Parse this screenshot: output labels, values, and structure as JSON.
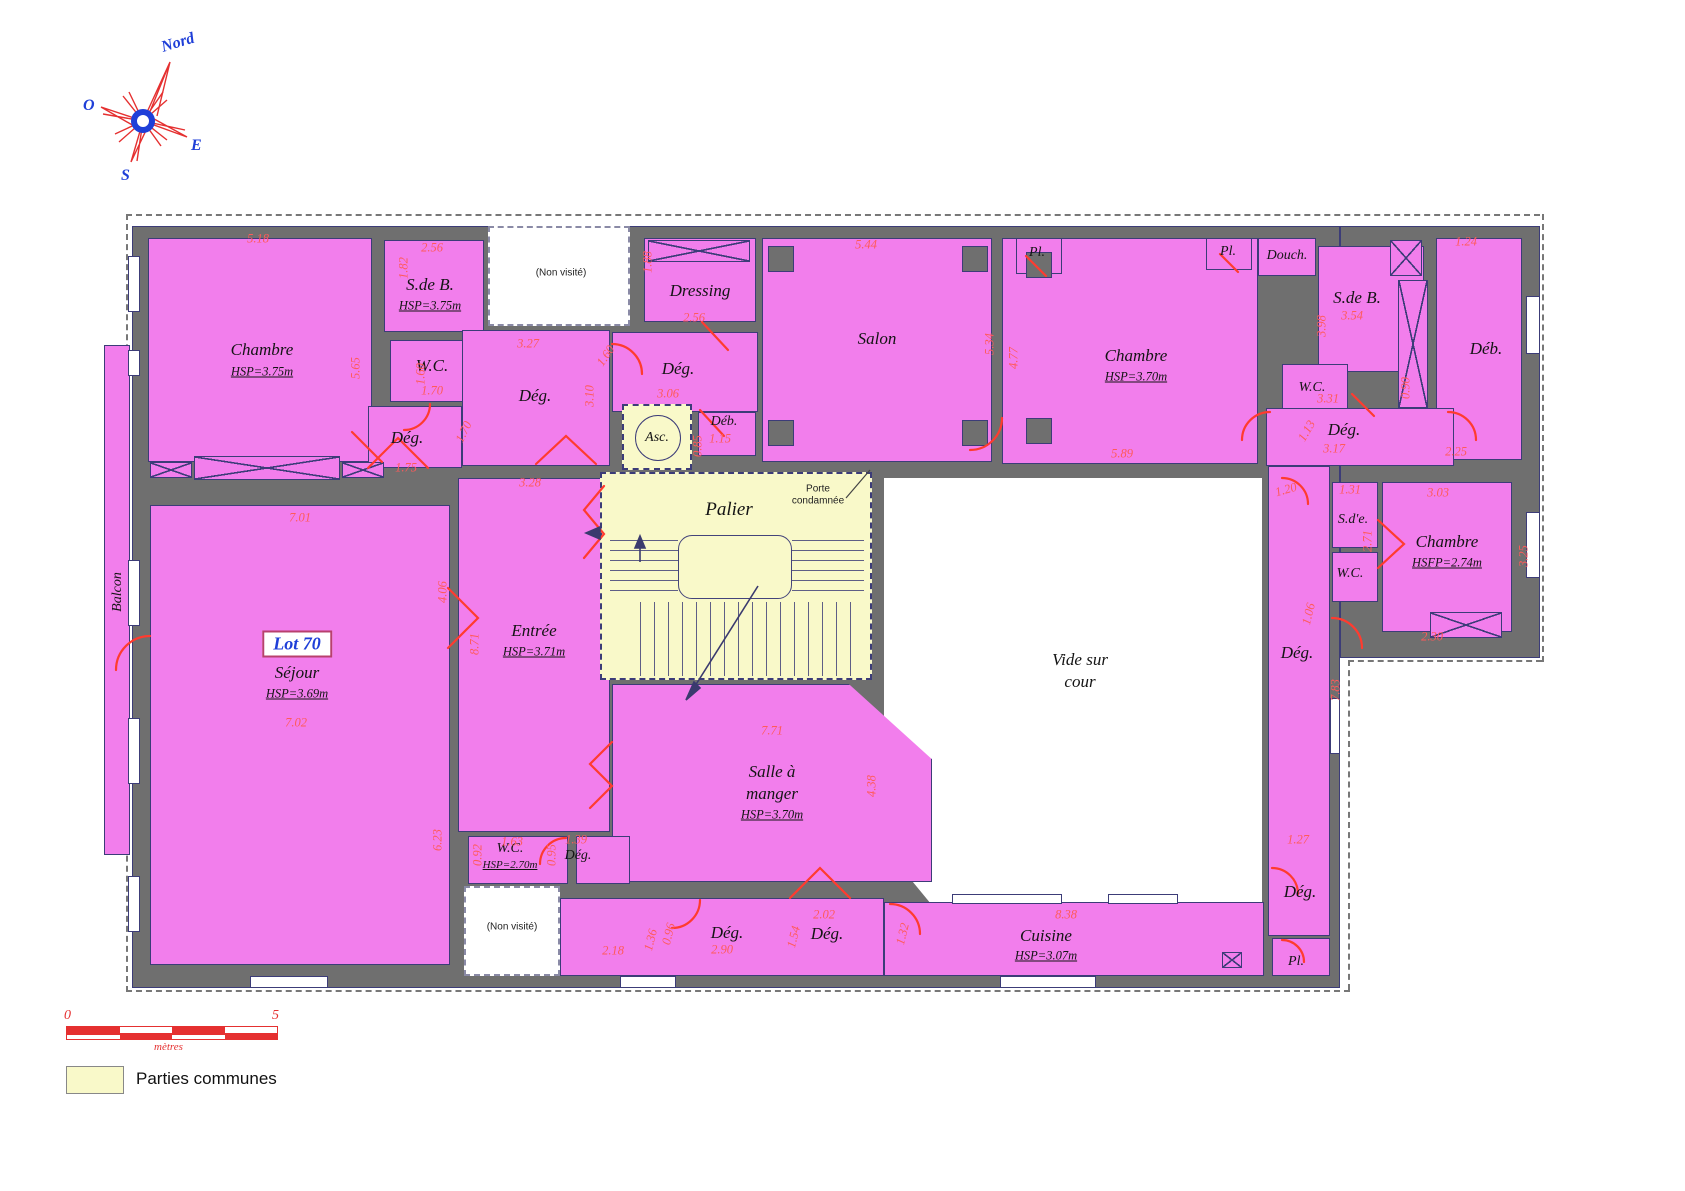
{
  "colors": {
    "room_pink": "#F27EEC",
    "common_yellow": "#F9F9C9",
    "wall_gray": "#6F6F6F",
    "dimension_red": "#FF5A5A",
    "door_red": "#FF3B2F",
    "accent_blue": "#1F3FD8"
  },
  "compass": {
    "north": "Nord",
    "west": "O",
    "east": "E",
    "south": "S"
  },
  "lot": {
    "label": "Lot 70"
  },
  "rooms": {
    "chambre_tl": {
      "label": "Chambre",
      "hsp": "HSP=3.75m"
    },
    "sdb_tl": {
      "label": "S.de B.",
      "hsp": "HSP=3.75m"
    },
    "wc_tl": {
      "label": "W.C."
    },
    "deg_tl": {
      "label": "Dég."
    },
    "deg_c1": {
      "label": "Dég."
    },
    "dressing": {
      "label": "Dressing"
    },
    "deg_c2": {
      "label": "Dég."
    },
    "deb_c": {
      "label": "Déb."
    },
    "asc": {
      "label": "Asc."
    },
    "salon": {
      "label": "Salon"
    },
    "pl_1": {
      "label": "Pl."
    },
    "chambre_tr": {
      "label": "Chambre",
      "hsp": "HSP=3.70m"
    },
    "pl_2": {
      "label": "Pl."
    },
    "douch": {
      "label": "Douch."
    },
    "sdb_tr": {
      "label": "S.de B."
    },
    "deb_r": {
      "label": "Déb."
    },
    "wc_tr": {
      "label": "W.C."
    },
    "deg_r1": {
      "label": "Dég."
    },
    "sde": {
      "label": "S.d'e."
    },
    "wc_r2": {
      "label": "W.C."
    },
    "chambre_r": {
      "label": "Chambre",
      "hsp": "HSFP=2.74m"
    },
    "deg_r2": {
      "label": "Dég."
    },
    "palier": {
      "label": "Palier"
    },
    "entree": {
      "label": "Entrée",
      "hsp": "HSP=3.71m"
    },
    "sejour": {
      "label": "Séjour",
      "hsp": "HSP=3.69m"
    },
    "salle": {
      "l1": "Salle à",
      "l2": "manger",
      "hsp": "HSP=3.70m"
    },
    "wc_b": {
      "label": "W.C.",
      "hsp": "HSP=2.70m"
    },
    "deg_b1": {
      "label": "Dég."
    },
    "deg_b2": {
      "label": "Dég."
    },
    "deg_b3": {
      "label": "Dég."
    },
    "cuisine": {
      "label": "Cuisine",
      "hsp": "HSP=3.07m"
    },
    "pl_b": {
      "label": "Pl."
    },
    "deg_br": {
      "label": "Dég."
    },
    "vide": {
      "l1": "Vide sur",
      "l2": "cour"
    },
    "balcon": {
      "label": "Balcon"
    }
  },
  "annotations": {
    "porte_l1": "Porte",
    "porte_l2": "condamnée",
    "non_visite": "(Non visité)"
  },
  "dims": [
    "5.18",
    "2.56",
    "1.82",
    "5.65",
    "1.60",
    "1.70",
    "1.75",
    "1.70",
    "3.27",
    "3.10",
    "1.60",
    "1.88",
    "2.56",
    "3.06",
    "0.85",
    "1.15",
    "5.44",
    "5.34",
    "4.77",
    "5.89",
    "1.24",
    "3.98",
    "3.54",
    "0.90",
    "3.31",
    "1.13",
    "3.17",
    "2.25",
    "1.20",
    "1.31",
    "2.71",
    "3.03",
    "3.25",
    "2.30",
    "1.06",
    "7.83",
    "7.01",
    "4.06",
    "8.71",
    "3.28",
    "7.02",
    "6.23",
    "0.92",
    "1.63",
    "0.95",
    "1.39",
    "7.71",
    "4.38",
    "2.18",
    "1.36",
    "0.96",
    "2.90",
    "2.02",
    "1.54",
    "1.32",
    "8.38",
    "1.27"
  ],
  "scale_bar": {
    "zero": "0",
    "five": "5",
    "unit": "mètres"
  },
  "legend": {
    "label": "Parties communes"
  }
}
